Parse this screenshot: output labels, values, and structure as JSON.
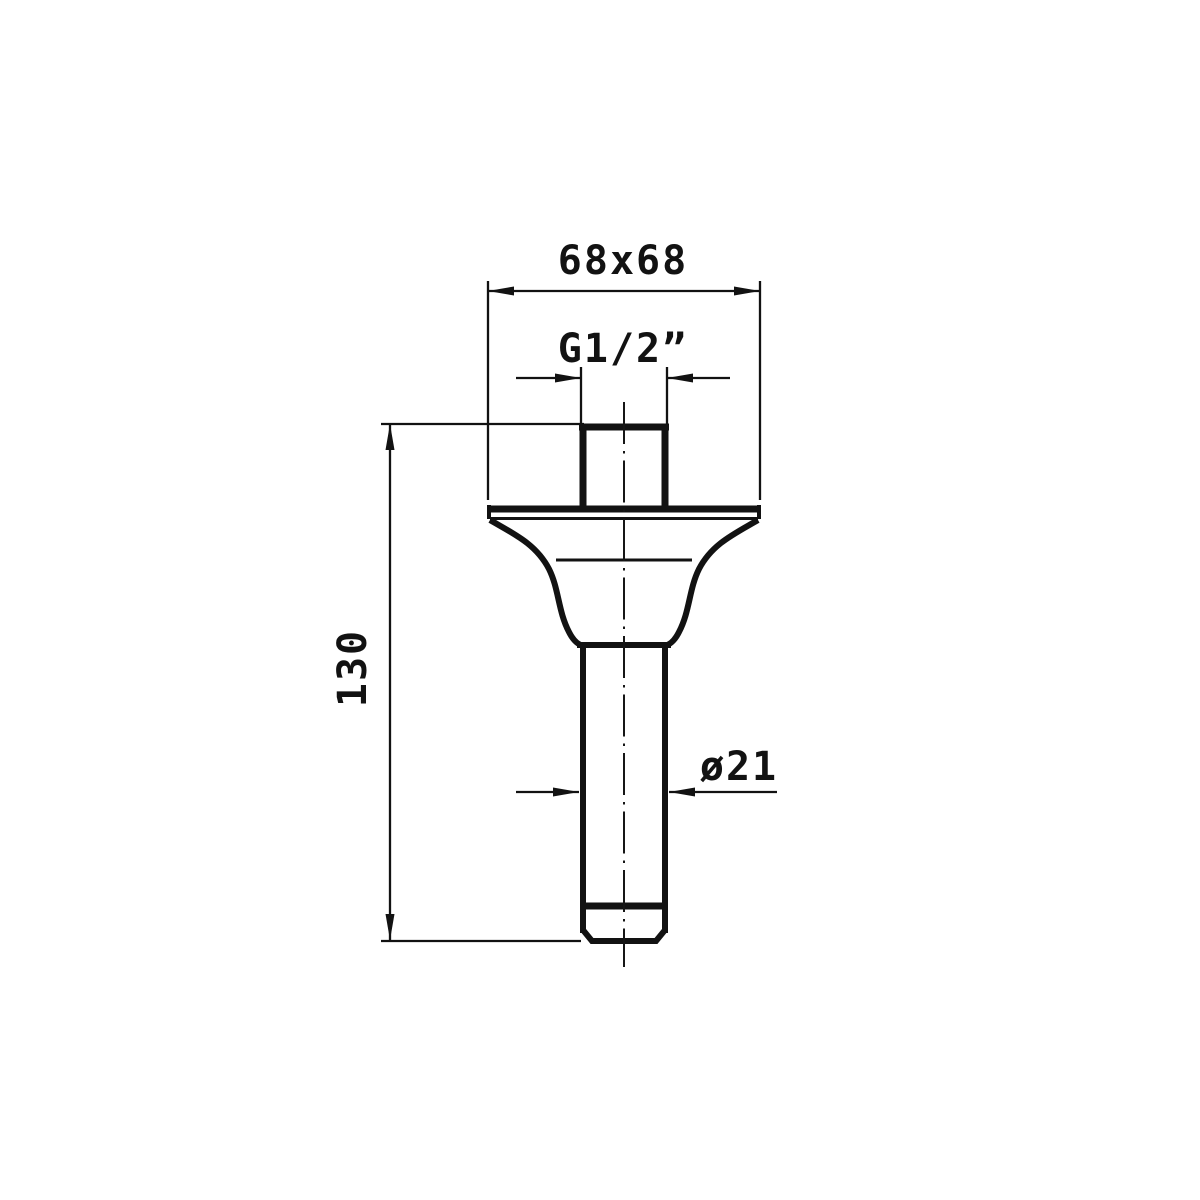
{
  "drawing": {
    "background_color": "#ffffff",
    "line_color": "#121212",
    "dimensions": [
      {
        "id": "plate-size",
        "label": "68x68"
      },
      {
        "id": "thread-size",
        "label": "G1/2”"
      },
      {
        "id": "overall-length",
        "label": "130"
      },
      {
        "id": "tube-diameter",
        "label": "ø21"
      }
    ]
  }
}
